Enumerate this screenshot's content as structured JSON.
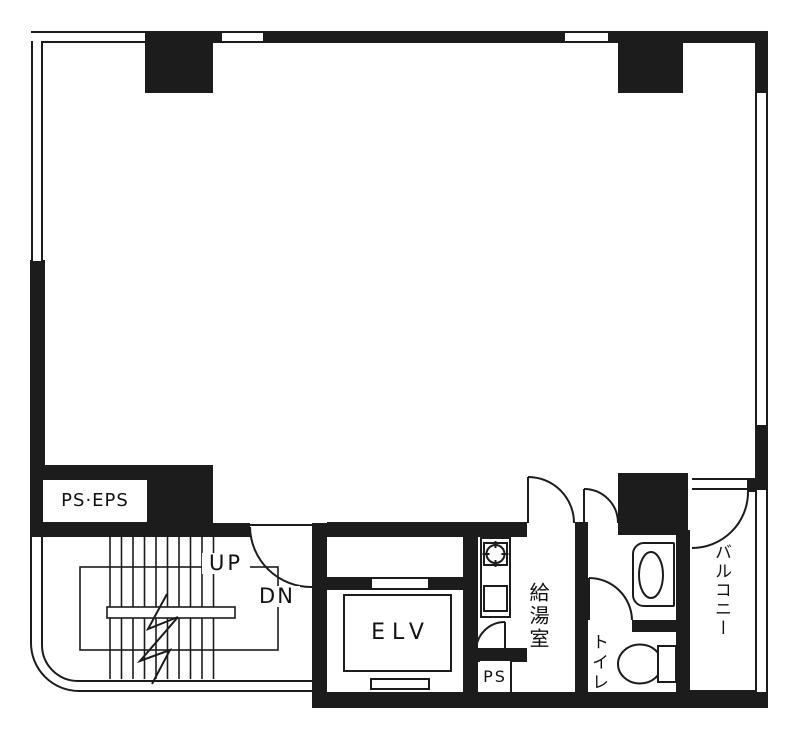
{
  "plan": {
    "type": "architectural-floor-plan",
    "labels": {
      "shaft": "PS·EPS",
      "stairs_up": "UP",
      "stairs_down": "DN",
      "elevator": "ELV",
      "pipe_space": "PS",
      "kitchenette": "給湯室",
      "toilet": "トイレ",
      "balcony": "バルコニー"
    },
    "colors": {
      "wall": "#1c1c1c",
      "background": "#ffffff",
      "line": "#1a1a1a"
    }
  }
}
